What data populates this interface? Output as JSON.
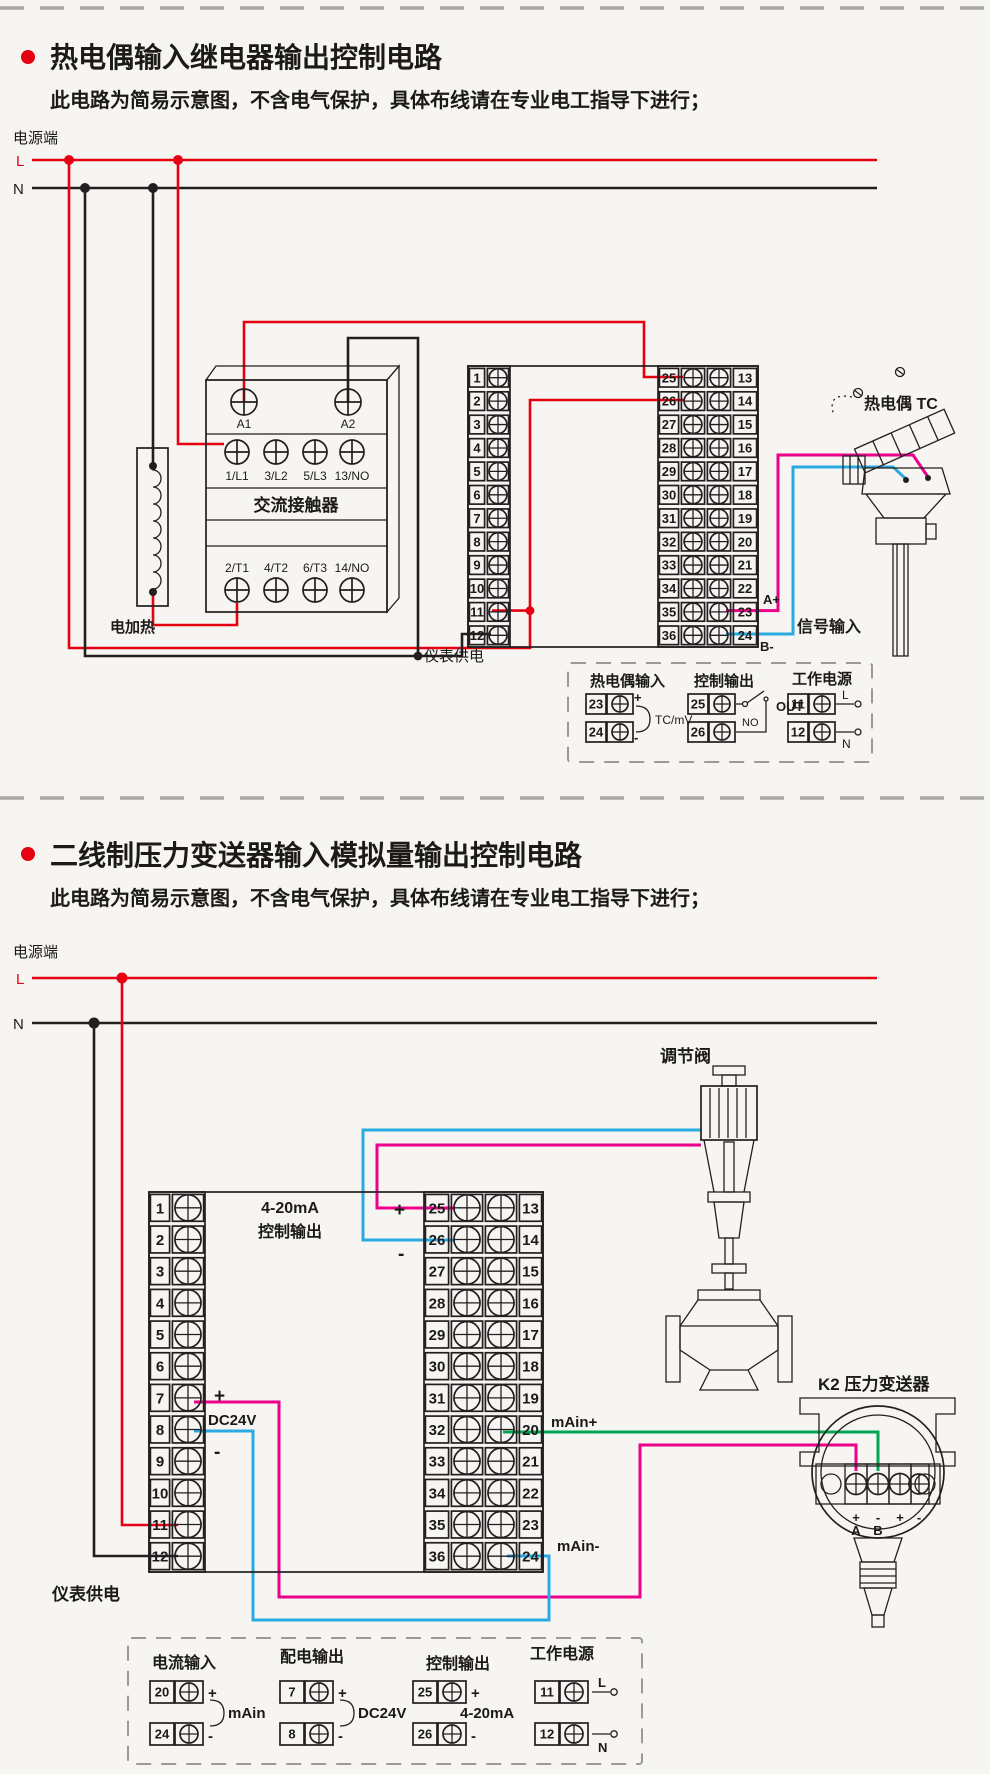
{
  "colors": {
    "red": "#e60012",
    "black": "#231f20",
    "pink": "#ec008c",
    "blue": "#29abe2",
    "green": "#00a651",
    "dash_gray": "#a9a8a6"
  },
  "section1": {
    "title": "热电偶输入继电器输出控制电路",
    "subtitle": "此电路为简易示意图，不含电气保护，具体布线请在专业电工指导下进行；",
    "power_label": "电源端",
    "line_l": "L",
    "line_n": "N",
    "contactor": {
      "name": "交流接触器",
      "coil_terminals": [
        "A1",
        "A2"
      ],
      "top_terminals": [
        "1/L1",
        "3/L2",
        "5/L3",
        "13/NO"
      ],
      "bottom_terminals": [
        "2/T1",
        "4/T2",
        "6/T3",
        "14/NO"
      ]
    },
    "heater_label": "电加热",
    "instrument_power_label": "仪表供电",
    "left_terminals": [
      "1",
      "2",
      "3",
      "4",
      "5",
      "6",
      "7",
      "8",
      "9",
      "10",
      "11",
      "12"
    ],
    "right_terminals_inner": [
      "25",
      "26",
      "27",
      "28",
      "29",
      "30",
      "31",
      "32",
      "33",
      "34",
      "35",
      "36"
    ],
    "right_terminals_outer": [
      "13",
      "14",
      "15",
      "16",
      "17",
      "18",
      "19",
      "20",
      "21",
      "22",
      "23",
      "24"
    ],
    "tc_label": "热电偶 TC",
    "signal_input_label": "信号输入",
    "a_plus": "A+",
    "b_minus": "B-",
    "legend": {
      "columns": [
        {
          "header": "热电偶输入",
          "rows": [
            {
              "no": "23",
              "mark": "+"
            },
            {
              "no": "24",
              "mark": "-"
            }
          ],
          "value": "TC/mV"
        },
        {
          "header": "控制输出",
          "rows": [
            {
              "no": "25"
            },
            {
              "no": "26"
            }
          ],
          "no_label": "NO",
          "value": "OUT"
        },
        {
          "header": "工作电源",
          "rows": [
            {
              "no": "11",
              "mark": "L"
            },
            {
              "no": "12",
              "mark": "N"
            }
          ]
        }
      ]
    }
  },
  "section2": {
    "title": "二线制压力变送器输入模拟量输出控制电路",
    "subtitle": "此电路为简易示意图，不含电气保护，具体布线请在专业电工指导下进行；",
    "power_label": "电源端",
    "line_l": "L",
    "line_n": "N",
    "valve_label": "调节阀",
    "transmitter_label": "K2 压力变送器",
    "transmitter_marks": [
      "+",
      "-",
      "+",
      "-"
    ],
    "transmitter_pins": [
      "A",
      "B"
    ],
    "output_label_line1": "4-20mA",
    "output_label_line2": "控制输出",
    "out_plus": "+",
    "out_minus": "-",
    "dc_plus": "+",
    "dc_minus": "-",
    "dc24v": "DC24V",
    "main_plus": "mAin+",
    "main_minus": "mAin-",
    "instrument_power_label": "仪表供电",
    "left_terminals": [
      "1",
      "2",
      "3",
      "4",
      "5",
      "6",
      "7",
      "8",
      "9",
      "10",
      "11",
      "12"
    ],
    "right_terminals_inner": [
      "25",
      "26",
      "27",
      "28",
      "29",
      "30",
      "31",
      "32",
      "33",
      "34",
      "35",
      "36"
    ],
    "right_terminals_outer": [
      "13",
      "14",
      "15",
      "16",
      "17",
      "18",
      "19",
      "20",
      "21",
      "22",
      "23",
      "24"
    ],
    "legend": {
      "columns": [
        {
          "header": "电流输入",
          "rows": [
            {
              "no": "20",
              "mark": "+"
            },
            {
              "no": "24",
              "mark": "-"
            }
          ],
          "value": "mAin"
        },
        {
          "header": "配电输出",
          "rows": [
            {
              "no": "7",
              "mark": "+"
            },
            {
              "no": "8",
              "mark": "-"
            }
          ],
          "value": "DC24V"
        },
        {
          "header": "控制输出",
          "rows": [
            {
              "no": "25",
              "mark": "+"
            },
            {
              "no": "26",
              "mark": "-"
            }
          ],
          "value": "4-20mA"
        },
        {
          "header": "工作电源",
          "rows": [
            {
              "no": "11",
              "mark": "L"
            },
            {
              "no": "12",
              "mark": "N"
            }
          ]
        }
      ]
    }
  }
}
